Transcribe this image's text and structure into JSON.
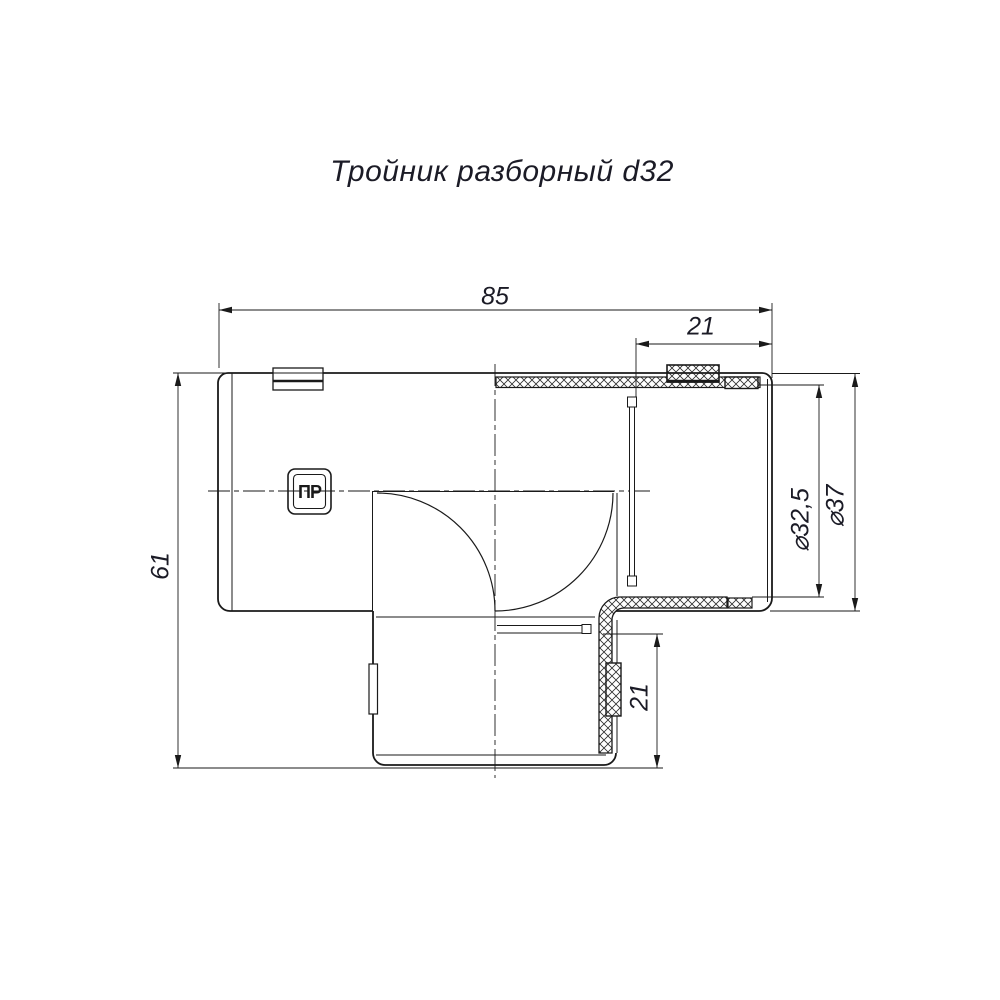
{
  "drawing": {
    "title": "Тройник разборный d32",
    "part_marking": "ПР",
    "dimensions": {
      "overall_length": "85",
      "spigot_length_top": "21",
      "overall_height": "61",
      "spigot_length_bottom": "21",
      "inner_diameter": "⌀32,5",
      "outer_diameter": "⌀37"
    }
  },
  "colors": {
    "line": "#1a1a1a",
    "text": "#1b1b26",
    "background": "#ffffff"
  }
}
